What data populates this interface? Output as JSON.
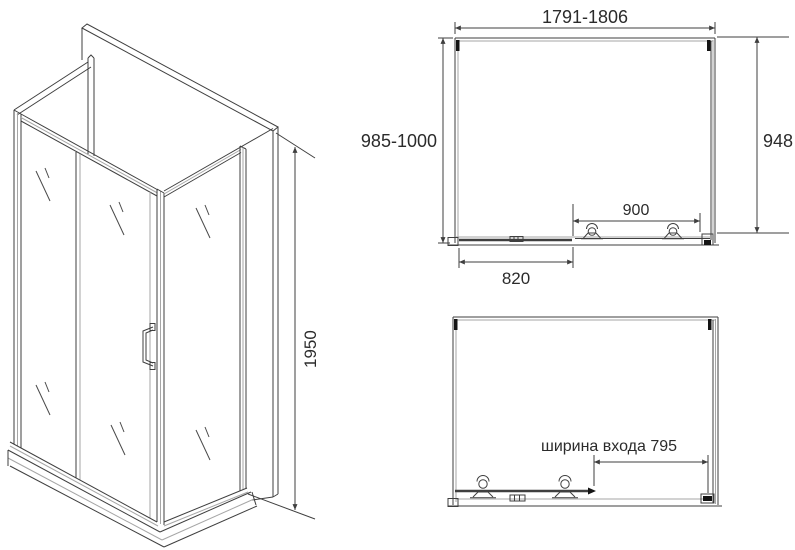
{
  "colors": {
    "line": "#3f3f3f",
    "light": "#a6a6a6",
    "black": "#141414",
    "text": "#2b2b2b",
    "bg": "#ffffff"
  },
  "iso_view": {
    "description": "isometric drawing of U-shaped shower enclosure with sliding door, handle and tray",
    "height_dim": "1950"
  },
  "plan_view": {
    "description": "top section view of enclosure with roller rail",
    "overall_width_dim": "1791-1806",
    "depth_dim": "985-1000",
    "side_height_dim": "948",
    "door_width_dim": "900",
    "fixed_panel_dim": "820"
  },
  "open_view": {
    "description": "front view with door slid open",
    "entrance_width_dim": "ширина входа 795"
  }
}
